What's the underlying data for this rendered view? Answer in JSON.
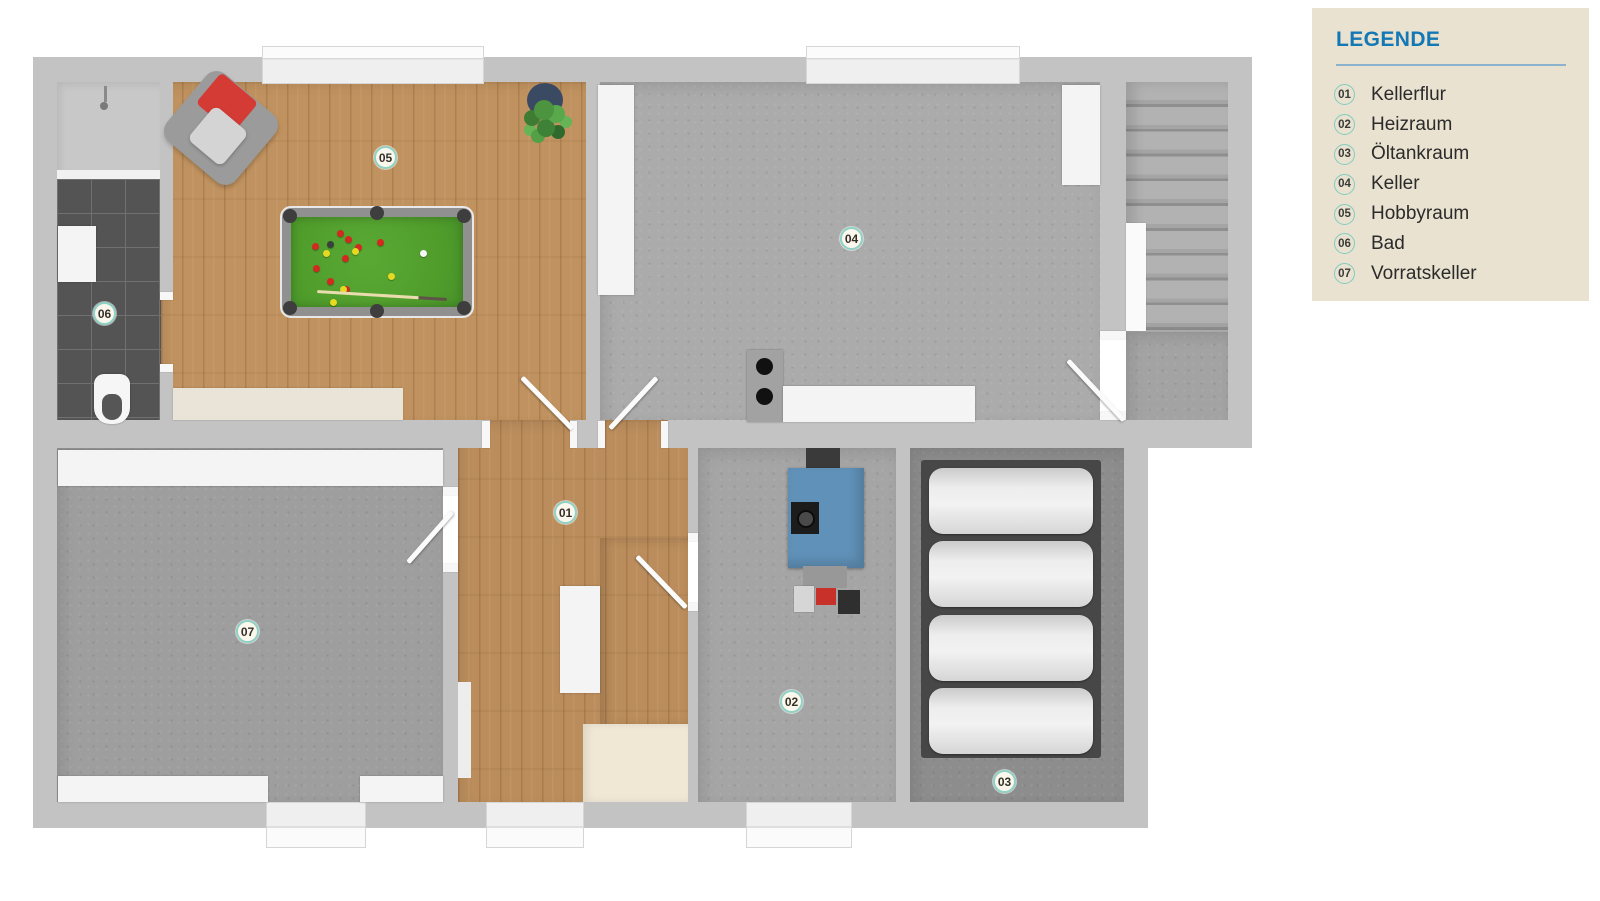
{
  "page": {
    "background": "#ffffff"
  },
  "legend": {
    "title": "LEGENDE",
    "items": [
      {
        "number": "01",
        "label": "Kellerflur"
      },
      {
        "number": "02",
        "label": "Heizraum"
      },
      {
        "number": "03",
        "label": "Öltankraum"
      },
      {
        "number": "04",
        "label": "Keller"
      },
      {
        "number": "05",
        "label": "Hobbyraum"
      },
      {
        "number": "06",
        "label": "Bad"
      },
      {
        "number": "07",
        "label": "Vorratskeller"
      }
    ],
    "colors": {
      "panel_bg": "#e9e2d0",
      "title": "#1478b5",
      "divider": "#8bb3cd",
      "badge_border": "#7fccc0",
      "text": "#2b2b2b"
    }
  },
  "floorplan": {
    "type": "basement-floor-plan",
    "markers": [
      {
        "number": "01",
        "room": "Kellerflur"
      },
      {
        "number": "02",
        "room": "Heizraum"
      },
      {
        "number": "03",
        "room": "Öltankraum"
      },
      {
        "number": "04",
        "room": "Keller"
      },
      {
        "number": "05",
        "room": "Hobbyraum"
      },
      {
        "number": "06",
        "room": "Bad"
      },
      {
        "number": "07",
        "room": "Vorratskeller"
      }
    ],
    "colors": {
      "wall": "#c3c3c3",
      "concrete_light": "#ababab",
      "concrete_mid": "#9e9e9e",
      "concrete_dark": "#8d8d8d",
      "wood": "#c0925f",
      "stairs_cream": "#e8dcc6",
      "bath_tile": "#545454",
      "pool_felt": "#4f9c2b",
      "boiler_blue": "#6091b8",
      "accent_red": "#d22a20",
      "marker_border": "#8ed2c6"
    }
  }
}
